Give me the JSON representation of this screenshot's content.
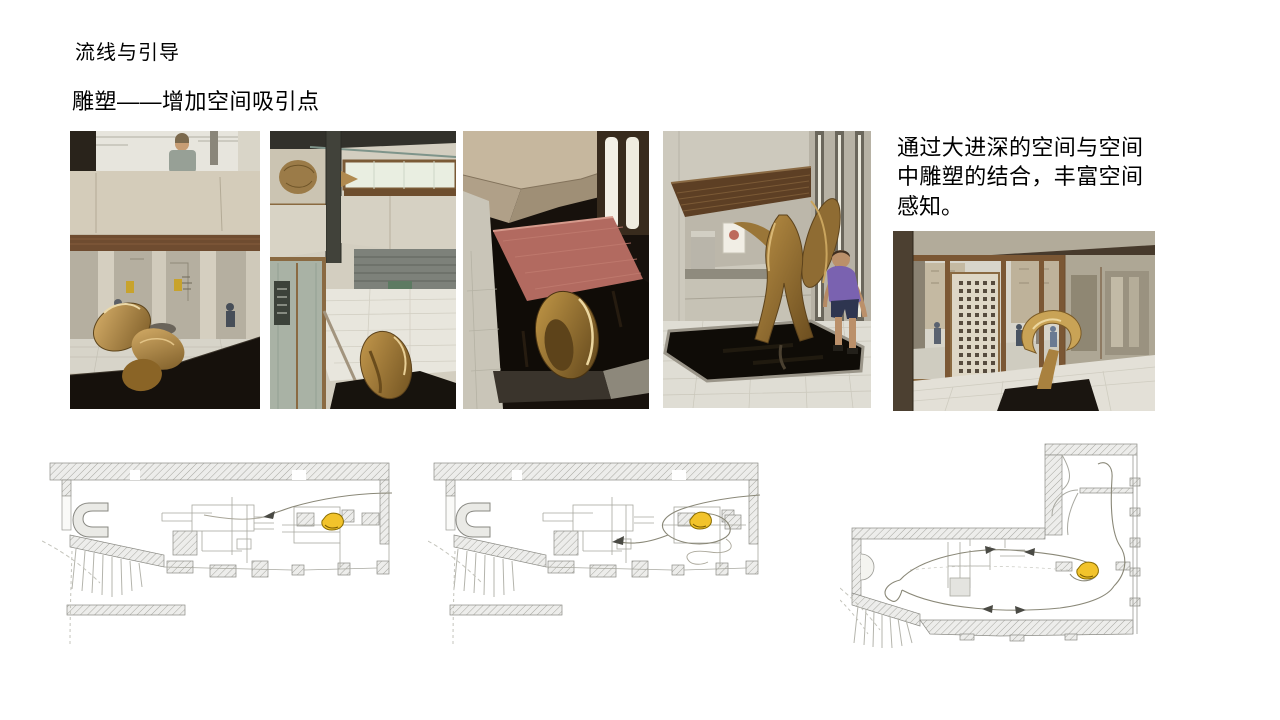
{
  "slide": {
    "title": "流线与引导",
    "subtitle": "雕塑——增加空间吸引点",
    "annotation": "通过大进深的空间与空间中雕塑的结合，丰富空间感知。"
  },
  "figures": {
    "photo_1": "bronze-sculpture-in-entrance-hall-photo",
    "photo_2": "sculpture-overhead-corner-view-photo",
    "photo_3": "sculpture-red-platform-black-pool-photo",
    "photo_4": "sculpture-reflecting-pool-with-child-photo",
    "photo_5": "showroom-glass-entrance-view-photo",
    "plan_1": "floor-plan-circulation-route-1",
    "plan_2": "floor-plan-circulation-route-2",
    "plan_3": "overall-floor-plan-circulation"
  },
  "colors": {
    "background": "#ffffff",
    "text": "#000000",
    "plan_highlight_yellow": "#f2c32b",
    "sculpture_bronze": "#a9813f",
    "plan_line_gray": "#8a8878"
  }
}
